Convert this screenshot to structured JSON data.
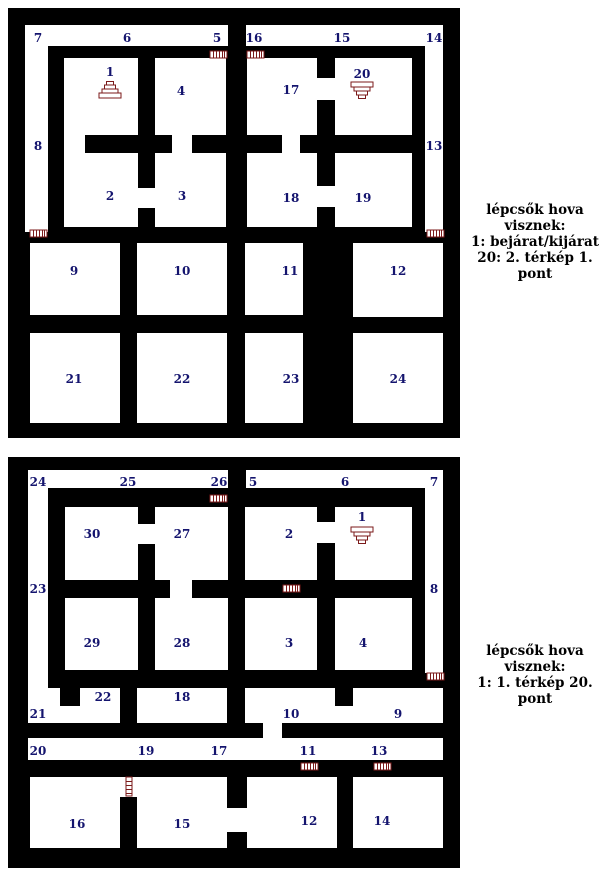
{
  "colors": {
    "wall": "#000000",
    "floor": "#ffffff",
    "room_label": "#14146e",
    "stairs_and_doors": "#7b1a1a",
    "legend_text": "#000000"
  },
  "map1": {
    "labels": [
      "7",
      "6",
      "5",
      "16",
      "15",
      "14",
      "8",
      "13",
      "1",
      "4",
      "17",
      "20",
      "2",
      "3",
      "18",
      "19",
      "9",
      "10",
      "11",
      "12",
      "21",
      "22",
      "23",
      "24"
    ],
    "stairs": [
      {
        "at_room": "1",
        "direction": "up"
      },
      {
        "at_room": "20",
        "direction": "down"
      }
    ],
    "legend": {
      "title": "lépcsők hova visznek:",
      "lines": [
        "1: bejárat/kijárat",
        "20: 2. térkép 1. pont"
      ]
    }
  },
  "map2": {
    "labels": [
      "24",
      "25",
      "26",
      "5",
      "6",
      "7",
      "23",
      "8",
      "30",
      "27",
      "2",
      "1",
      "29",
      "28",
      "3",
      "4",
      "21",
      "22",
      "18",
      "10",
      "9",
      "20",
      "19",
      "17",
      "11",
      "13",
      "16",
      "15",
      "12",
      "14"
    ],
    "stairs": [
      {
        "at_room": "1",
        "direction": "down"
      }
    ],
    "legend": {
      "title": "lépcsők hova visznek:",
      "lines": [
        "1: 1. térkép 20. pont"
      ]
    }
  }
}
